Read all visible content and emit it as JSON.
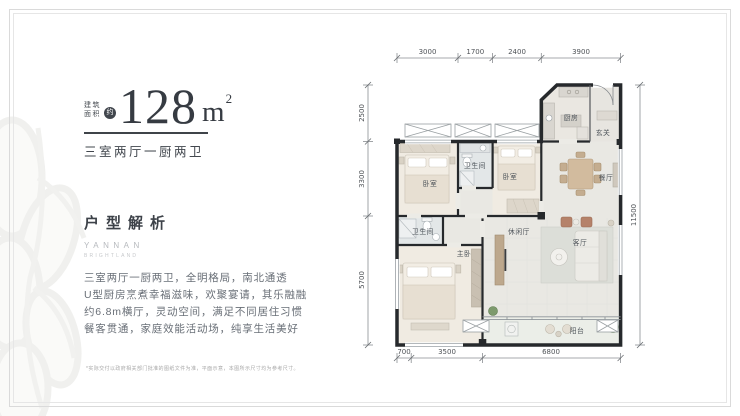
{
  "header": {
    "area_label": [
      "建筑",
      "面积"
    ],
    "area_approx": "约",
    "area_value": "128",
    "area_unit": "m",
    "area_unit_sup": "2",
    "layout_type": "三室两厅一厨两卫"
  },
  "analysis": {
    "title": "户型解析",
    "brand": "YANNAN",
    "brand_sub": "BRIGHTLAND",
    "lines": [
      "三室两厅一厨两卫，全明格局，南北通透",
      "U型厨房烹煮幸福滋味，欢聚宴请，其乐融融",
      "约6.8m横厅，灵动空间，满足不同居住习惯",
      "餐客贯通，家庭效能活动场，纯享生活美好"
    ]
  },
  "floorplan": {
    "rooms": {
      "kitchen": "厨房",
      "foyer": "玄关",
      "dining": "餐厅",
      "bath1": "卫生间",
      "bedroom1": "卧室",
      "bedroom2": "卧室",
      "bath2": "卫生间",
      "master": "主卧",
      "leisure": "休闲厅",
      "living": "客厅",
      "balcony": "阳台"
    },
    "dims": {
      "top": [
        "3000",
        "1700",
        "2400",
        "3900"
      ],
      "left": [
        "2500",
        "3300",
        "5700"
      ],
      "right": [
        "11500"
      ],
      "bottom": [
        "700",
        "3500",
        "6800"
      ]
    }
  },
  "footer": {
    "disclaimer": "*实际交付以政府相关部门批准的图纸文件为准，平面示意，本图所示尺寸均为参考尺寸。"
  },
  "colors": {
    "wall": "#26292c",
    "accent_text": "#3d4249",
    "body_text": "#696f77",
    "dim_text": "#4f5357"
  }
}
